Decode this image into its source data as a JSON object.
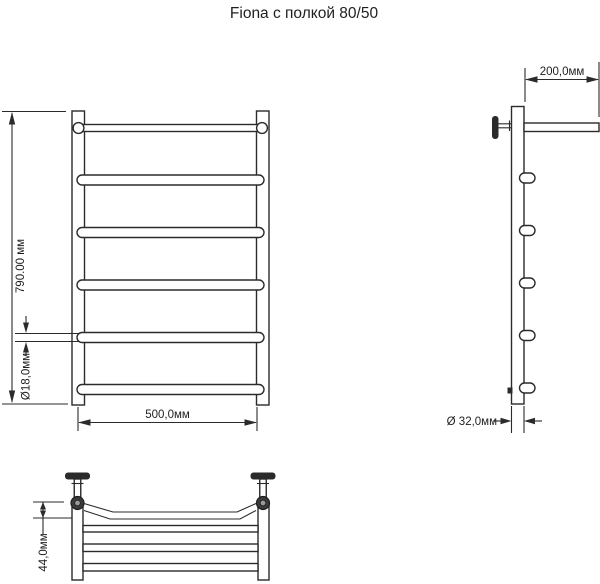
{
  "title": "Fiona с полкой 80/50",
  "views": {
    "front": {
      "height_label": "790.00 мм",
      "width_label": "500,0мм",
      "rail_diameter_label": "Ø18,0мм"
    },
    "side": {
      "shelf_depth_label": "200,0мм",
      "post_diameter_label": "Ø 32,0мм"
    },
    "top": {
      "shelf_offset_label": "44,0мм"
    }
  },
  "colors": {
    "background": "#ffffff",
    "line": "#2b2b2b",
    "text": "#1f1f1f"
  }
}
